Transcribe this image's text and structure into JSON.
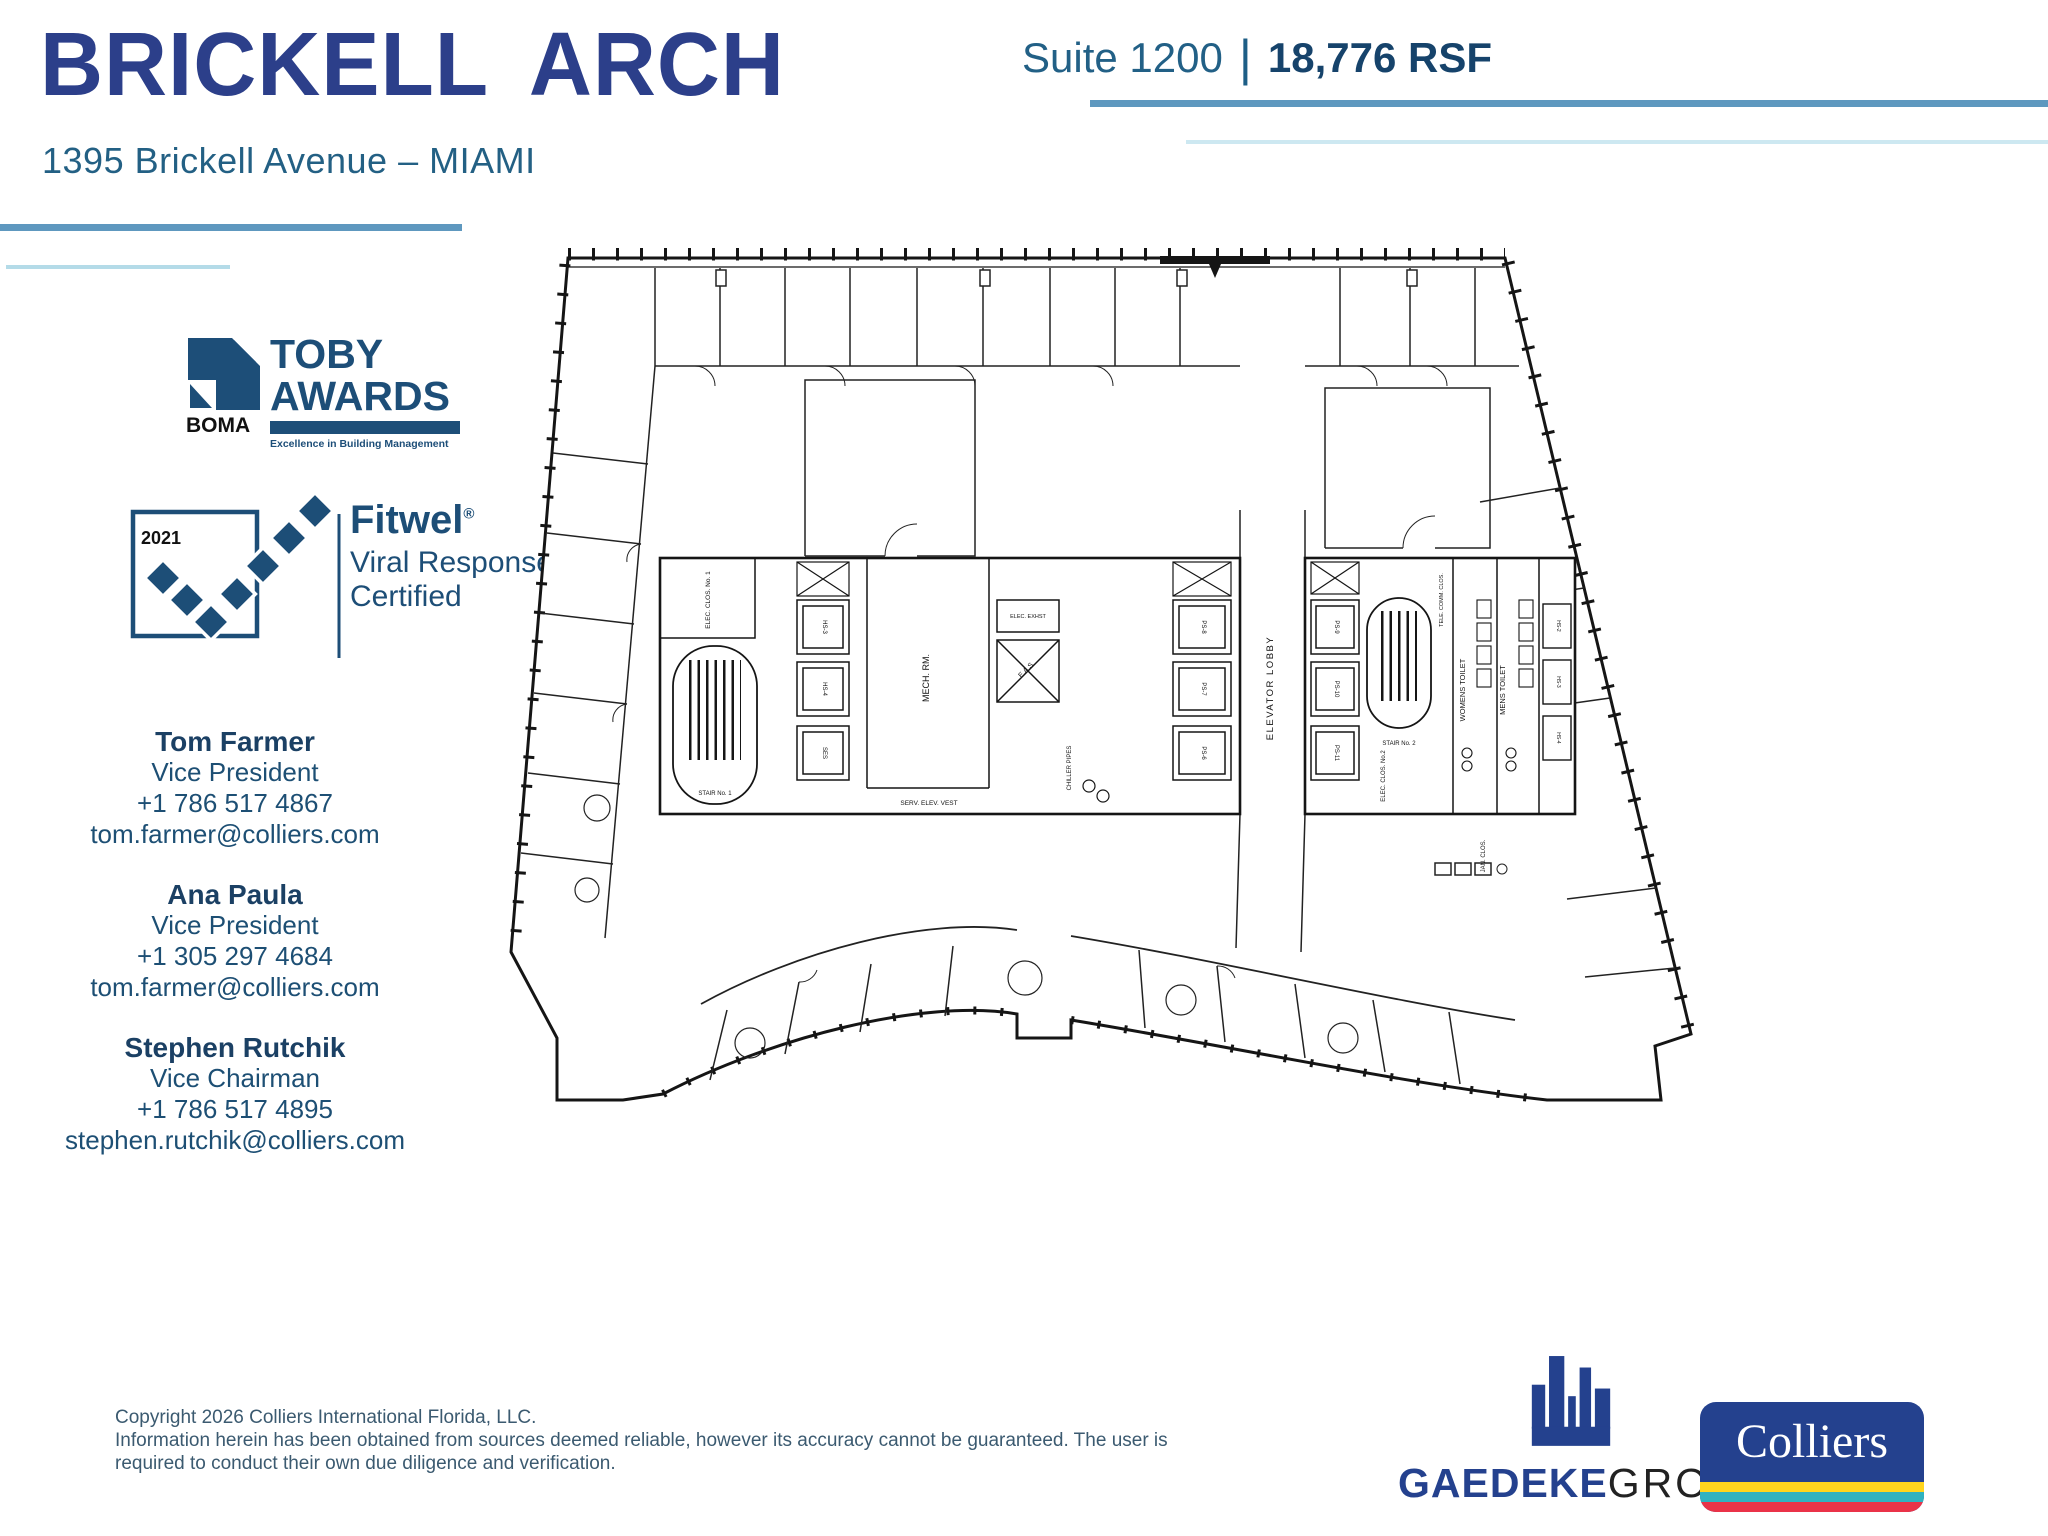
{
  "header": {
    "title": "BRICKELL ARCH",
    "address": "1395 Brickell Avenue – MIAMI",
    "suite_label": "Suite 1200",
    "separator": "|",
    "size_label": "18,776 RSF"
  },
  "badges": {
    "toby": {
      "org": "BOMA",
      "line1": "TOBY",
      "line2": "AWARDS",
      "tagline": "Excellence in Building Management"
    },
    "fitwel": {
      "year": "2021",
      "brand": "Fitwel",
      "reg": "®",
      "line1": "Viral Response",
      "line2": "Certified"
    }
  },
  "contacts": [
    {
      "name": "Tom Farmer",
      "title": "Vice President",
      "phone": "+1 786 517 4867",
      "email": "tom.farmer@colliers.com"
    },
    {
      "name": "Ana Paula",
      "title": "Vice President",
      "phone": "+1 305 297 4684",
      "email": "tom.farmer@colliers.com"
    },
    {
      "name": "Stephen Rutchik",
      "title": "Vice Chairman",
      "phone": "+1 786 517 4895",
      "email": "stephen.rutchik@colliers.com"
    }
  ],
  "floor_plan": {
    "labels": {
      "elevator_lobby": "ELEVATOR LOBBY",
      "mech_rm": "MECH. RM.",
      "serv_elev_vest": "SERV. ELEV. VEST",
      "chiller_pipes": "CHILLER PIPES",
      "eas": "E.A.S.",
      "elec_exhst": "ELEC. EXHST",
      "elec_clos_1": "ELEC. CLOS. No. 1",
      "elec_clos_2": "ELEC. CLOS. No.2",
      "tele_comm_clos": "TELE. COMM. CLOS.",
      "jan_clos": "JAN. CLOS.",
      "womens_toilet": "WOMENS TOILET",
      "mens_toilet": "MENS TOILET",
      "stair_1": "STAIR No. 1",
      "stair_2": "STAIR No. 2"
    },
    "elevator_cabs": [
      "HS-3",
      "HS-4",
      "SES",
      "PS-8",
      "PS-7",
      "PS-6",
      "PS-9",
      "PS-10",
      "PS-11",
      "HS-2",
      "HS-3",
      "HS-4"
    ]
  },
  "footer": {
    "copyright_line1": "Copyright 2026 Colliers International Florida, LLC.",
    "copyright_line2": "Information herein has been obtained from sources deemed reliable, however its accuracy cannot be guaranteed. The user is",
    "copyright_line3": "required to conduct their own due diligence and verification.",
    "gaedeke_bold": "GAEDEKE",
    "gaedeke_light": "GROUP",
    "colliers_logo": "Colliers"
  },
  "colors": {
    "title_navy": "#2c3f8a",
    "slate_blue": "#236084",
    "steel_rule": "#5e98bf",
    "light_rule": "#b4dbe8",
    "badge_navy": "#1d4e77",
    "colliers_navy": "#24418e",
    "stripe_yellow": "#ffd51e",
    "stripe_teal": "#30b2c0",
    "stripe_red": "#ea3348"
  }
}
